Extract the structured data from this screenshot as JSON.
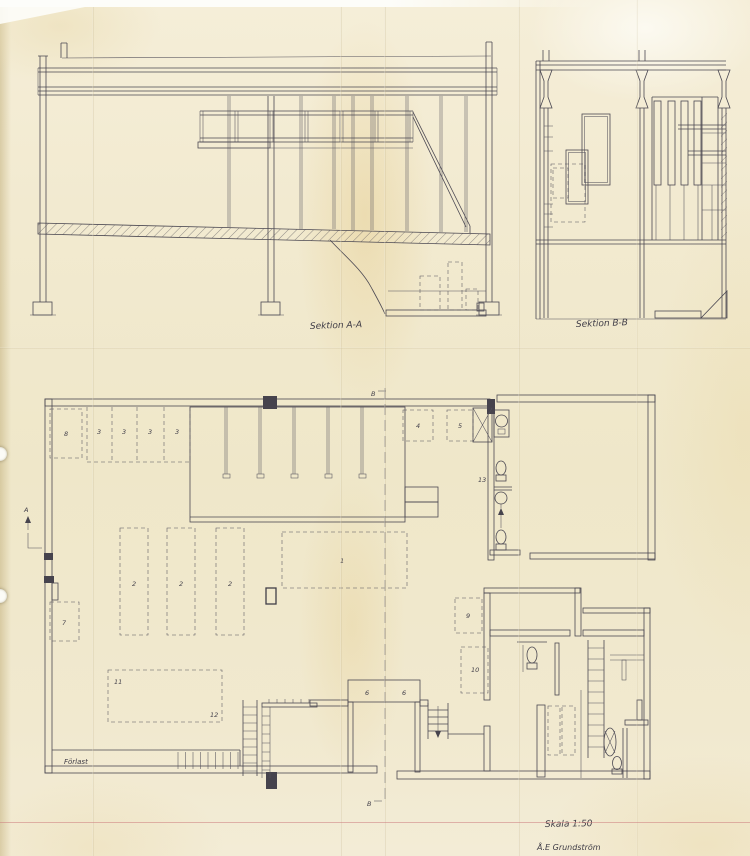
{
  "drawing": {
    "section_a": {
      "label": "Sektion A-A"
    },
    "section_b": {
      "label": "Sektion B-B"
    },
    "scale": "Skala 1:50",
    "signature": "Å.E Grundström",
    "plan": {
      "dock_label": "Förlast",
      "section_marker_a": "A",
      "section_marker_b": "B",
      "numbers": {
        "n1": "1",
        "n2": "2",
        "n3": "3",
        "n4": "4",
        "n5": "5",
        "n6": "6",
        "n7": "7",
        "n8": "8",
        "n9": "9",
        "n10": "10",
        "n11": "11",
        "n12": "12",
        "n13": "13"
      }
    },
    "colors": {
      "paper": "#f1e9cc",
      "ink": "#4b4852"
    }
  }
}
